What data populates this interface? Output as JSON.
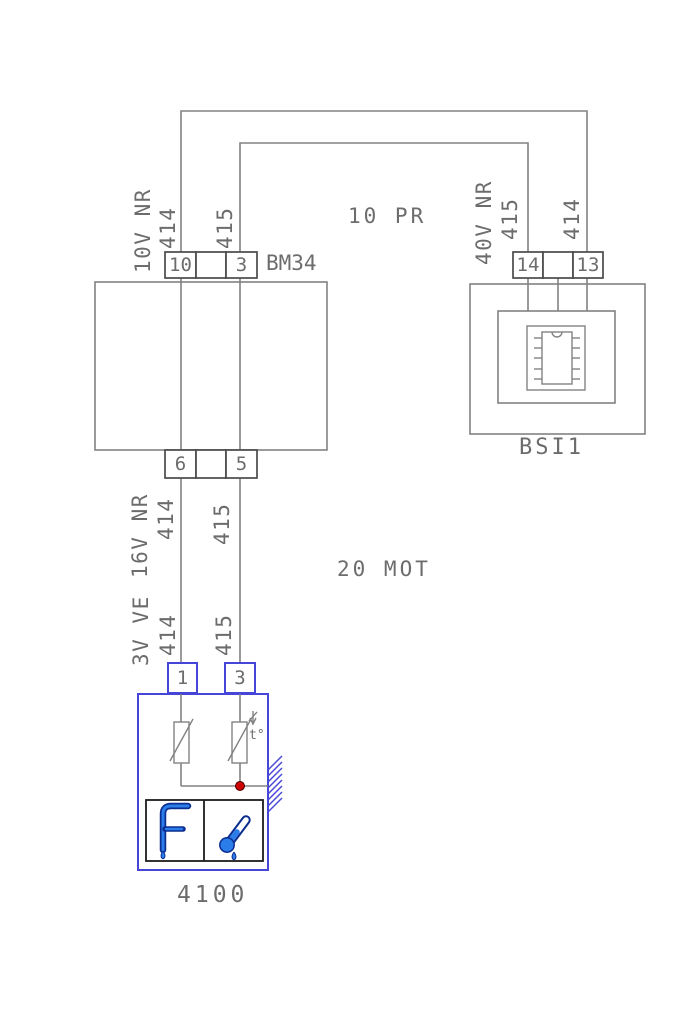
{
  "colors": {
    "line_gray": "#828282",
    "text_gray": "#6c6c6c",
    "connector_gray": "#4a4a4a",
    "highlight_blue": "#4545d8",
    "icon_blue": "#2b7de9",
    "icon_navy": "#0b2d8f",
    "junction_red": "#cc0000"
  },
  "zones": {
    "top": "10 PR",
    "middle": "20 MOT"
  },
  "components": {
    "bm34": {
      "label": "BM34",
      "top_pins": [
        "10",
        "3"
      ],
      "bottom_pins": [
        "6",
        "5"
      ]
    },
    "bsi1": {
      "label": "BSI1",
      "pins": [
        "14",
        "13"
      ]
    },
    "sensor_4100": {
      "label": "4100",
      "pins": [
        "1",
        "3"
      ],
      "thermistor_note": "t°"
    }
  },
  "wire_labels": {
    "bm34_top": {
      "harness": "10V NR",
      "wire_left": "414",
      "wire_right": "415"
    },
    "bsi1_top": {
      "harness": "40V NR",
      "wire_left": "415",
      "wire_right": "414"
    },
    "bm34_bottom": {
      "harness": "16V NR",
      "wire_left": "414",
      "wire_right": "415"
    },
    "sensor_top": {
      "harness": "3V VE",
      "wire_left": "414",
      "wire_right": "415"
    }
  }
}
